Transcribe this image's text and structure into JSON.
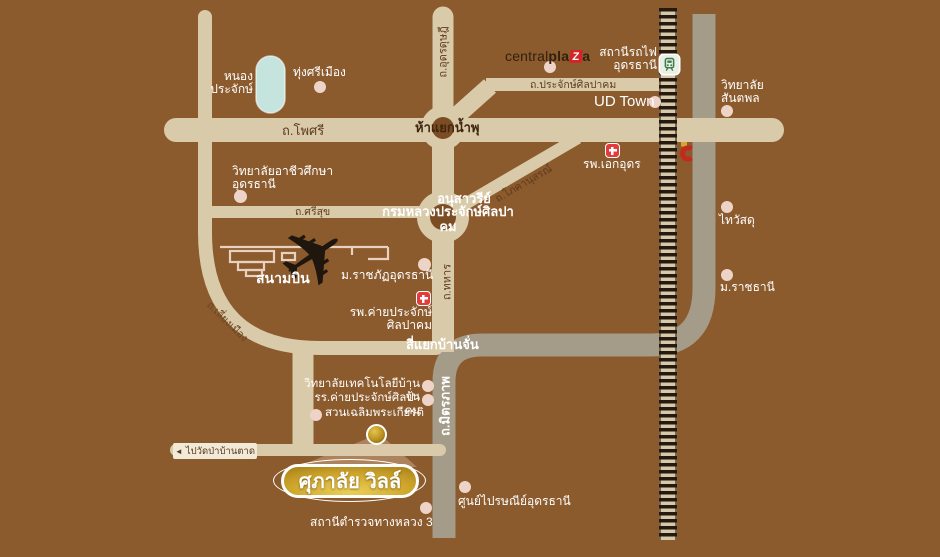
{
  "map": {
    "badge": "ศุภาลัย วิลล์",
    "airplane_glyph": "✈",
    "logo_central": {
      "a": "central",
      "b": "pla",
      "z": "Z",
      "c": "a"
    },
    "road_labels": {
      "pho_si": "ถ.โพศรี",
      "udon_dutsadi": "ถ.อุดรดุษฎี",
      "prajak_sinlapakhom": "ถ.ประจักษ์ศิลปาคม",
      "si_suk": "ถ.ศรีสุข",
      "phokhanuson": "ถ.โภคานุสรณ์",
      "thahan": "ถ.ทหาร",
      "liang_mueang": "ถ.เลี่ยงเมือง",
      "mittraphap": "ถ.มิตรภาพ"
    },
    "intersections": {
      "ha_yaek_nam_phu": "ห้าแยกน้ำพุ",
      "monument_1": "อนุสาวรีย์",
      "monument_2": "กรมหลวงประจักษ์ศิลปาคม",
      "si_yaek_ban_chan": "สี่แยกบ้านจั่น"
    },
    "places": {
      "nong_prajak": "หนอง\nประจักษ์",
      "thung_si_mueang": "ทุ่งศรีเมือง",
      "vocational_college": "วิทยาลัยอาชีวศึกษา\nอุดรธานี",
      "railway_station": "สถานีรถไฟ\nอุดรธานี",
      "ud_town": "UD Town",
      "santapol_college": "วิทยาลัย\nสันตพล",
      "aek_udon_hospital": "รพ.เอกอุดร",
      "thai_watsadu": "ไทวัสดุ",
      "airport": "สนามบิน",
      "rajabhat_university": "ม.ราชภัฏอุดรธานี",
      "ratchathani_university": "ม.ราชธานี",
      "camp_prajak_hospital": "รพ.ค่ายประจักษ์\nศิลปาคม",
      "ban_chan_tech_college": "วิทยาลัยเทคโนโลยีบ้านจั่น",
      "camp_prajak_school": "รร.ค่ายประจักษ์ศิลปาคม",
      "chaloem_phrakiat_park": "สวนเฉลิมพระเกียรติ",
      "postal_center": "ศูนย์ไปรษณีย์อุดรธานี",
      "highway_police": "สถานีตำรวจทางหลวง 3"
    },
    "signs": {
      "wat_pa_ban_tat_arrow": "◄",
      "wat_pa_ban_tat": "ไปวัดป่าบ้านตาด"
    },
    "colors": {
      "background": "#8b5a2d",
      "road": "#d9caa9",
      "highway": "#a49b88",
      "railway_tie": "#261a0e",
      "railway_light": "#d6c8ab",
      "pond": "#c5e4dd",
      "place_dot": "#eed4c8",
      "hospital_red": "#e23c3c",
      "brand_red": "#d5232a",
      "badge_gold": "#cfa62c",
      "road_label_brown": "#5f3c1e",
      "train_green": "#3c7a50"
    }
  }
}
